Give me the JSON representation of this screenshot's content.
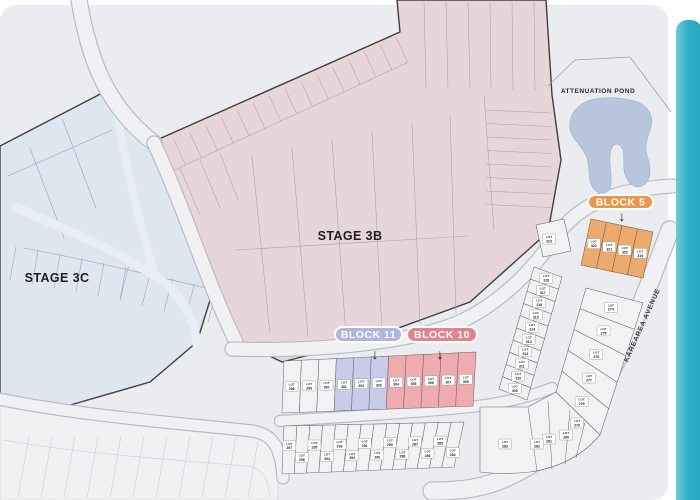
{
  "colors": {
    "map_bg": "#ebecef",
    "accent_bar": "#2fb0c8",
    "accent_bar_light": "#72cadd",
    "stage_3b_fill": "#e7d6d9",
    "stage_3c_fill": "#dfe6f0",
    "pond_fill": "#b7c6db",
    "road_fill": "#f1f1f4",
    "road_edge": "#b8bbc3",
    "block5_color": "#e8974f",
    "block5_lot_fill": "#edaa6e",
    "block11_color": "#b1b4de",
    "block11_lot_fill": "#cacbe9",
    "block10_color": "#e1848e",
    "block10_lot_fill": "#efabaf",
    "neutral_lot_fill": "#f2f2f4"
  },
  "labels": {
    "stage_3b": "STAGE 3B",
    "stage_3c": "STAGE 3C",
    "attenuation_pond": "ATTENUATION POND",
    "street_name": "KĀREAREA AVENUE",
    "lot_word": "LOT",
    "arrow_glyph": "↓"
  },
  "blocks": [
    {
      "id": "block-5",
      "label": "BLOCK 5",
      "color": "#e8974f",
      "lot_numbers": [
        "322",
        "321",
        "320",
        "319"
      ]
    },
    {
      "id": "block-11",
      "label": "BLOCK 11",
      "color": "#b1b4de",
      "lot_numbers": [
        "301",
        "302",
        "303"
      ]
    },
    {
      "id": "block-10",
      "label": "BLOCK 10",
      "color": "#e1848e",
      "lot_numbers": [
        "304",
        "305",
        "306",
        "307",
        "308"
      ]
    }
  ],
  "lot_groups": {
    "block5": [
      "322",
      "321",
      "320",
      "319"
    ],
    "lot_323": [
      "323"
    ],
    "upper_row": [
      "298",
      "299",
      "300",
      "301",
      "302",
      "303",
      "304",
      "305",
      "306",
      "307",
      "308"
    ],
    "lower_row": [
      "297",
      "296",
      "295",
      "294",
      "293",
      "292",
      "291",
      "290",
      "289",
      "288",
      "287",
      "286",
      "285",
      "284"
    ],
    "hillside_strip": [
      "318",
      "317",
      "316",
      "315",
      "314",
      "313",
      "312",
      "311",
      "310",
      "309"
    ],
    "avenue_column": [
      "274",
      "275",
      "276",
      "277",
      "278"
    ],
    "corner_fan": [
      "279",
      "280",
      "281",
      "282",
      "283"
    ]
  }
}
